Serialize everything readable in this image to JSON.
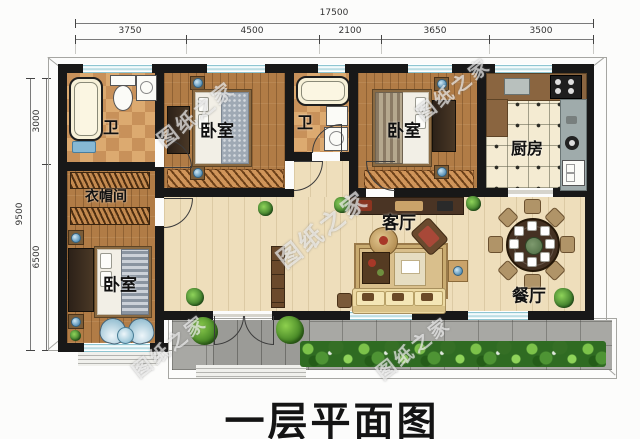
{
  "title": "一层平面图",
  "watermark": "图纸之家",
  "dimensions": {
    "top": {
      "total": "17500",
      "segments": [
        "3750",
        "4500",
        "2100",
        "3650",
        "3500"
      ]
    },
    "left": {
      "total": "9500",
      "segments": [
        "3000",
        "6500"
      ]
    }
  },
  "rooms": {
    "bath1": "卫",
    "bedroom1": "卧室",
    "bath2": "卫",
    "bedroom2": "卧室",
    "kitchen": "厨房",
    "cloakroom": "衣帽间",
    "living": "客厅",
    "dining": "餐厅",
    "bedroom3": "卧室"
  },
  "colors": {
    "wall": "#181818",
    "window_glass": "#cfeaee",
    "wood_floor": "#b17c46",
    "tile_floor": "#d9a468",
    "living_floor": "#eedebb",
    "kitchen_floor": "#f4ebd2",
    "pavement": "#a8a8a4",
    "shrub": "#2f6b22"
  }
}
